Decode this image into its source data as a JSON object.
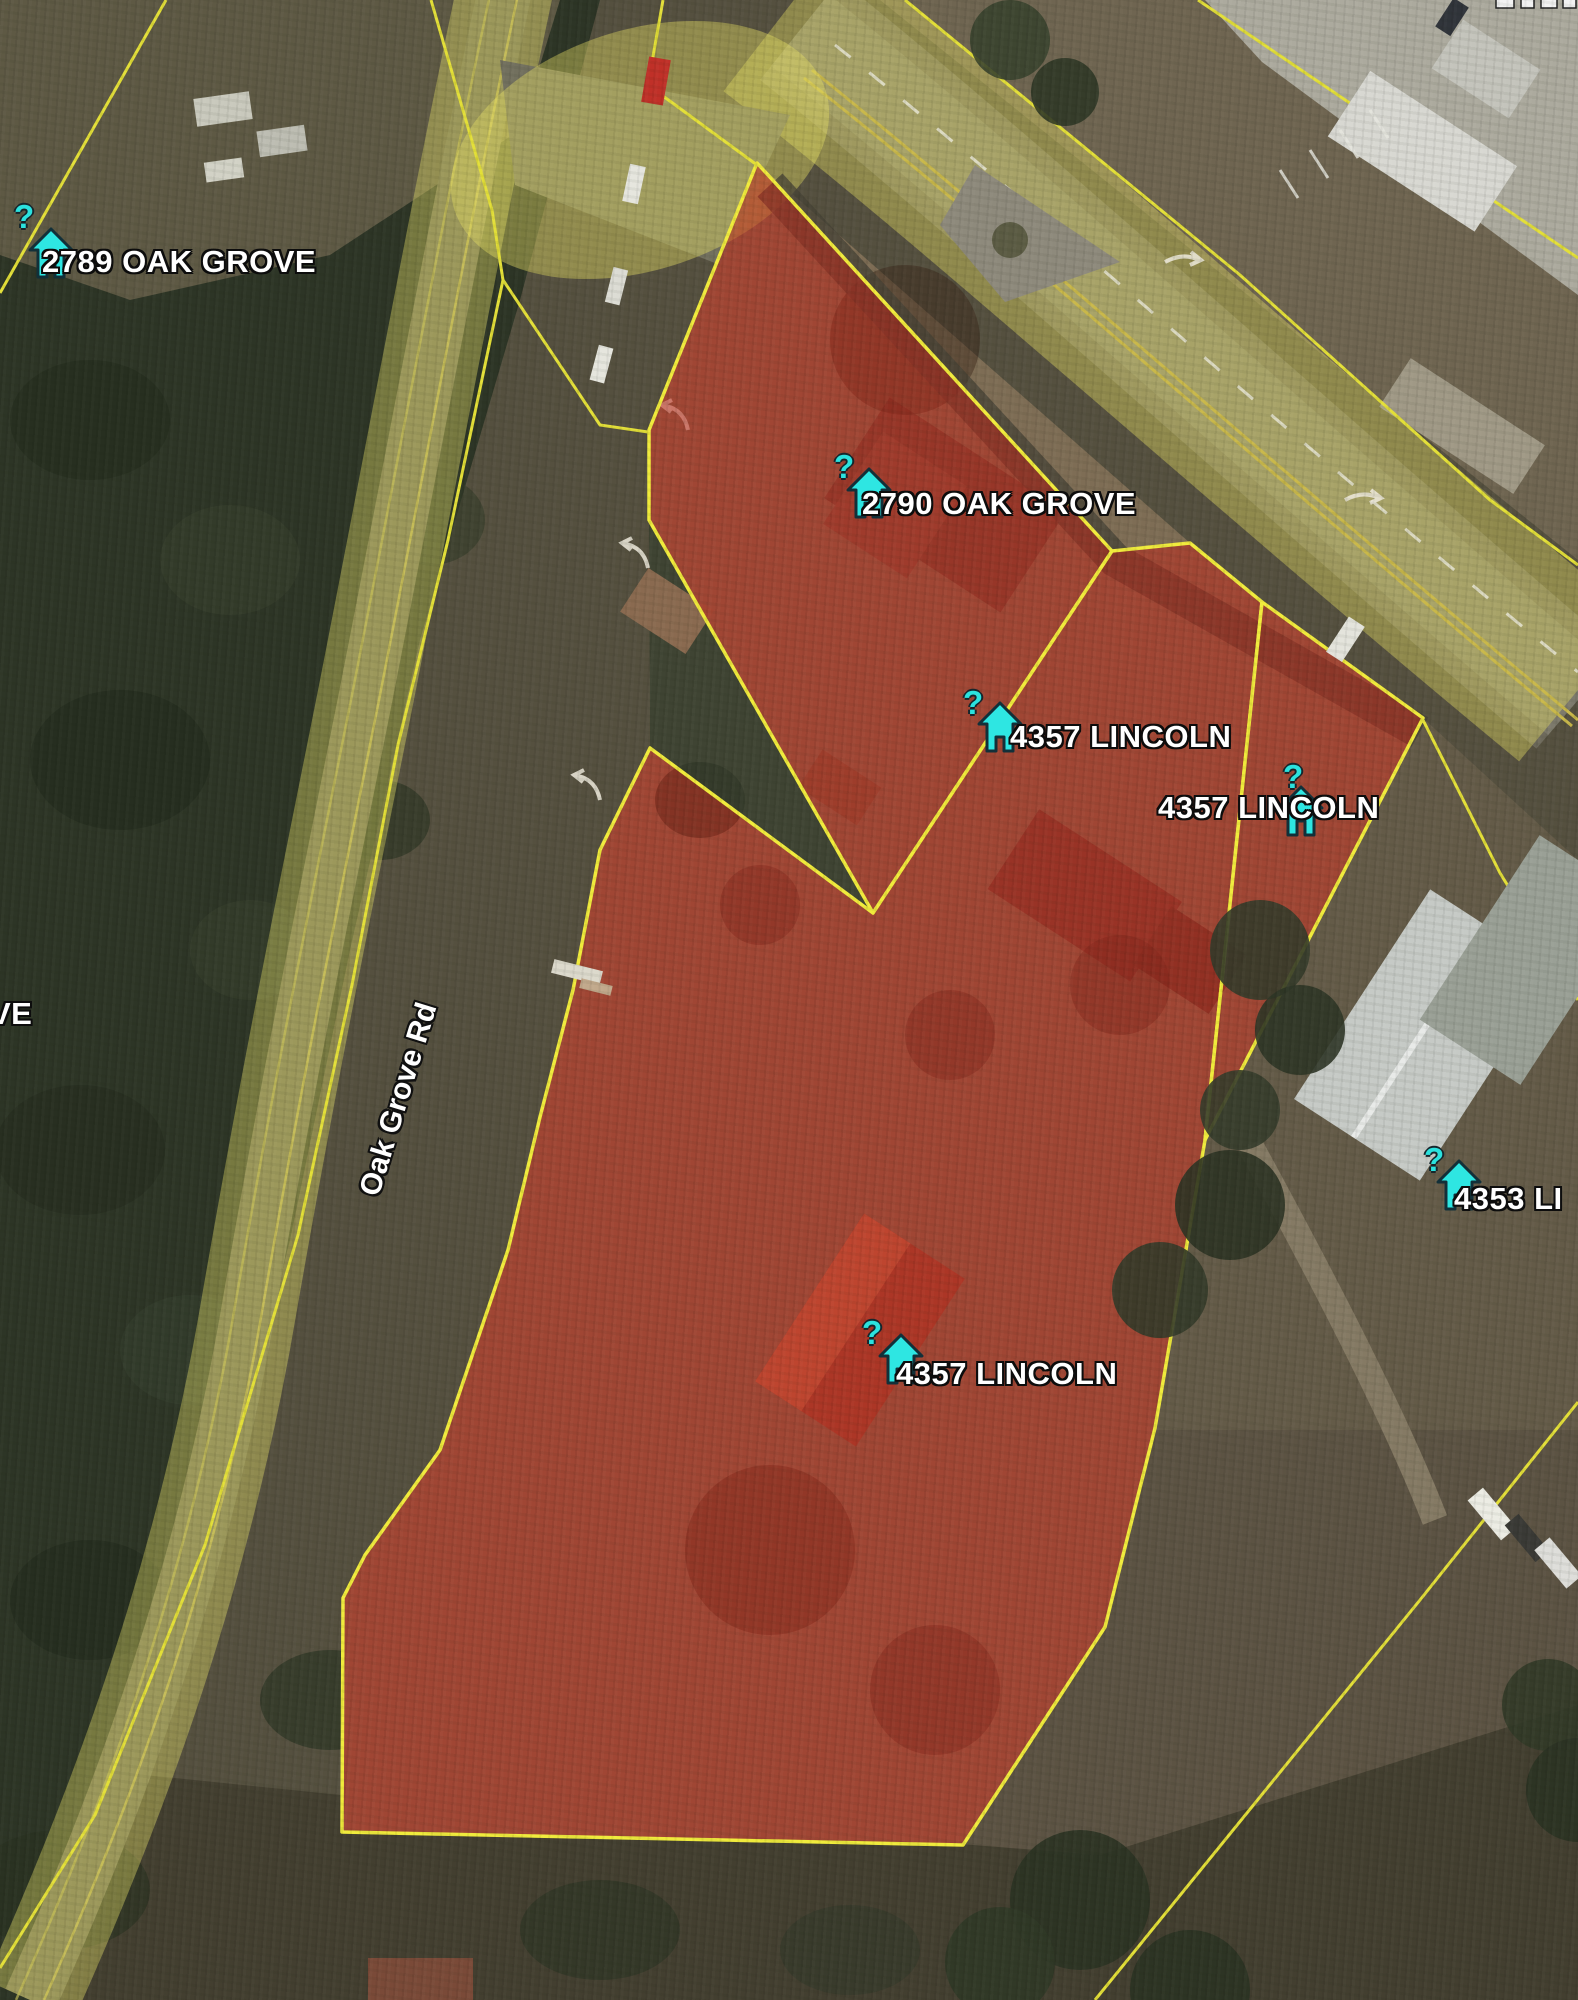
{
  "map": {
    "road_label": "Oak Grove Rd",
    "markers": [
      {
        "label": "2789 OAK GROVE",
        "query": "?"
      },
      {
        "label": "2790 OAK GROVE",
        "query": "?"
      },
      {
        "label": "4357 LINCOLN",
        "query": "?"
      },
      {
        "label": "4357 LINCOLN",
        "query": "?"
      },
      {
        "label": "4357 LINCOLN",
        "query": "?"
      },
      {
        "label": "4353 LI",
        "query": "?"
      }
    ],
    "edge_labels": [
      {
        "text": "VE"
      }
    ],
    "colors": {
      "selected_parcel_fill": "rgba(187,38,26,0.55)",
      "selected_parcel_outline": "#f0eb3c",
      "parcel_line": "#e3df38",
      "road_highlight": "rgba(232,226,100,0.40)",
      "marker_icon": "#2ee6e2",
      "label_text": "#ffffff"
    }
  }
}
